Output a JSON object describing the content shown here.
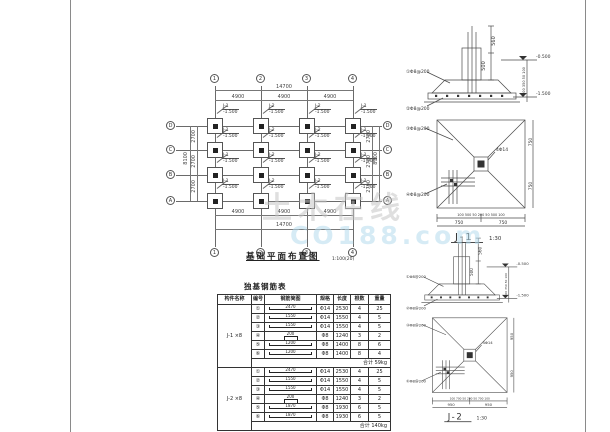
{
  "watermark": {
    "line1": "土木在线",
    "line2": "CO188.com"
  },
  "plan": {
    "title": "基础平面布置图",
    "scale": "1:100(20)",
    "axes_top": [
      "1",
      "2",
      "3",
      "4"
    ],
    "axes_bottom": [
      "1",
      "2",
      "3",
      "4"
    ],
    "axes_left": [
      "D",
      "C",
      "B",
      "A"
    ],
    "axes_right": [
      "D",
      "C",
      "B",
      "A"
    ],
    "dims_top_total": "14700",
    "dims_top": [
      "4900",
      "4900",
      "4900"
    ],
    "dims_bottom": [
      "4900",
      "4900",
      "4900"
    ],
    "dims_bottom_total": "14700",
    "dims_left": [
      "2700",
      "2700",
      "2700"
    ],
    "dims_left_total": "8100",
    "dims_right": [
      "2700",
      "2700",
      "2700"
    ],
    "dims_right_total": "8100",
    "footings": [
      {
        "name": "J-1",
        "elev": "-1.500"
      },
      {
        "name": "J-2",
        "elev": "-1.500"
      },
      {
        "name": "J-2",
        "elev": "-1.500"
      },
      {
        "name": "J-1",
        "elev": "-1.500"
      },
      {
        "name": "J-1",
        "elev": "-1.500"
      },
      {
        "name": "J-2",
        "elev": "-1.500"
      },
      {
        "name": "J-2",
        "elev": "-1.500"
      },
      {
        "name": "J-1",
        "elev": "-1.500"
      },
      {
        "name": "J-1",
        "elev": "-1.500"
      },
      {
        "name": "J-2",
        "elev": "-1.500"
      },
      {
        "name": "J-2",
        "elev": "-1.500"
      },
      {
        "name": "J-1",
        "elev": "-1.500"
      },
      {
        "name": "J-1",
        "elev": "-1.500"
      },
      {
        "name": "J-2",
        "elev": "-1.500"
      },
      {
        "name": "J-2",
        "elev": "-1.500"
      },
      {
        "name": "J-1",
        "elev": "-1.500"
      }
    ]
  },
  "table": {
    "title": "独基钢筋表",
    "headers": [
      "构件名称",
      "编号",
      "钢筋简图",
      "规格",
      "长度",
      "根数",
      "重量"
    ],
    "groups": [
      {
        "name": "J-1 ×8",
        "rows": [
          {
            "num": "①",
            "dim": "2470",
            "spec": "Φ14",
            "len": "2530",
            "qty": "4",
            "wt": "25"
          },
          {
            "num": "②",
            "dim": "1550",
            "spec": "Φ14",
            "len": "1550",
            "qty": "4",
            "wt": "5"
          },
          {
            "num": "③",
            "dim": "1550",
            "spec": "Φ14",
            "len": "1550",
            "qty": "4",
            "wt": "5"
          },
          {
            "num": "④",
            "dim": "200",
            "spec": "Φ8",
            "len": "1240",
            "qty": "3",
            "wt": "2"
          },
          {
            "num": "⑤",
            "dim": "1200",
            "spec": "Φ8",
            "len": "1400",
            "qty": "8",
            "wt": "6"
          },
          {
            "num": "⑥",
            "dim": "1200",
            "spec": "Φ8",
            "len": "1400",
            "qty": "8",
            "wt": "4"
          }
        ],
        "total_label": "合计",
        "total": "59kg"
      },
      {
        "name": "J-2 ×8",
        "rows": [
          {
            "num": "①",
            "dim": "2470",
            "spec": "Φ14",
            "len": "2530",
            "qty": "4",
            "wt": "25"
          },
          {
            "num": "②",
            "dim": "1550",
            "spec": "Φ14",
            "len": "1550",
            "qty": "4",
            "wt": "5"
          },
          {
            "num": "③",
            "dim": "1550",
            "spec": "Φ14",
            "len": "1550",
            "qty": "4",
            "wt": "5"
          },
          {
            "num": "④",
            "dim": "200",
            "spec": "Φ8",
            "len": "1240",
            "qty": "3",
            "wt": "2"
          },
          {
            "num": "⑤",
            "dim": "1870",
            "spec": "Φ8",
            "len": "1930",
            "qty": "6",
            "wt": "5"
          },
          {
            "num": "⑥",
            "dim": "1870",
            "spec": "Φ8",
            "len": "1930",
            "qty": "6",
            "wt": "5"
          }
        ],
        "total_label": "合计",
        "total": "140kg"
      }
    ]
  },
  "details": [
    {
      "title": "J-1",
      "scale": "1:30",
      "dim1": "560",
      "dim2": "500",
      "elev_top": "-0.500",
      "elev_bot": "-1.500",
      "leader1": "①Φ8@200",
      "leader2": "②Φ8@200",
      "right_chain": "100 350 50 100",
      "plan_leader1": "③Φ8@200",
      "plan_leader2": "④Φ8@200",
      "center_label": "4Φ14",
      "bottom_chain": "100 500 50 200 50 500 100",
      "half1": "750",
      "half2": "750"
    },
    {
      "title": "J-2",
      "scale": "1:30",
      "dim1": "560",
      "dim2": "500",
      "elev_top": "-0.500",
      "elev_bot": "-1.500",
      "leader1": "①Φ8@200",
      "leader2": "②Φ8@200",
      "right_chain": "100 350 50 100",
      "plan_leader1": "③Φ8@200",
      "plan_leader2": "④Φ8@200",
      "center_label": "4Φ14",
      "bottom_chain": "100 700 50 200 50 700 100",
      "half1": "950",
      "half2": "950"
    }
  ]
}
